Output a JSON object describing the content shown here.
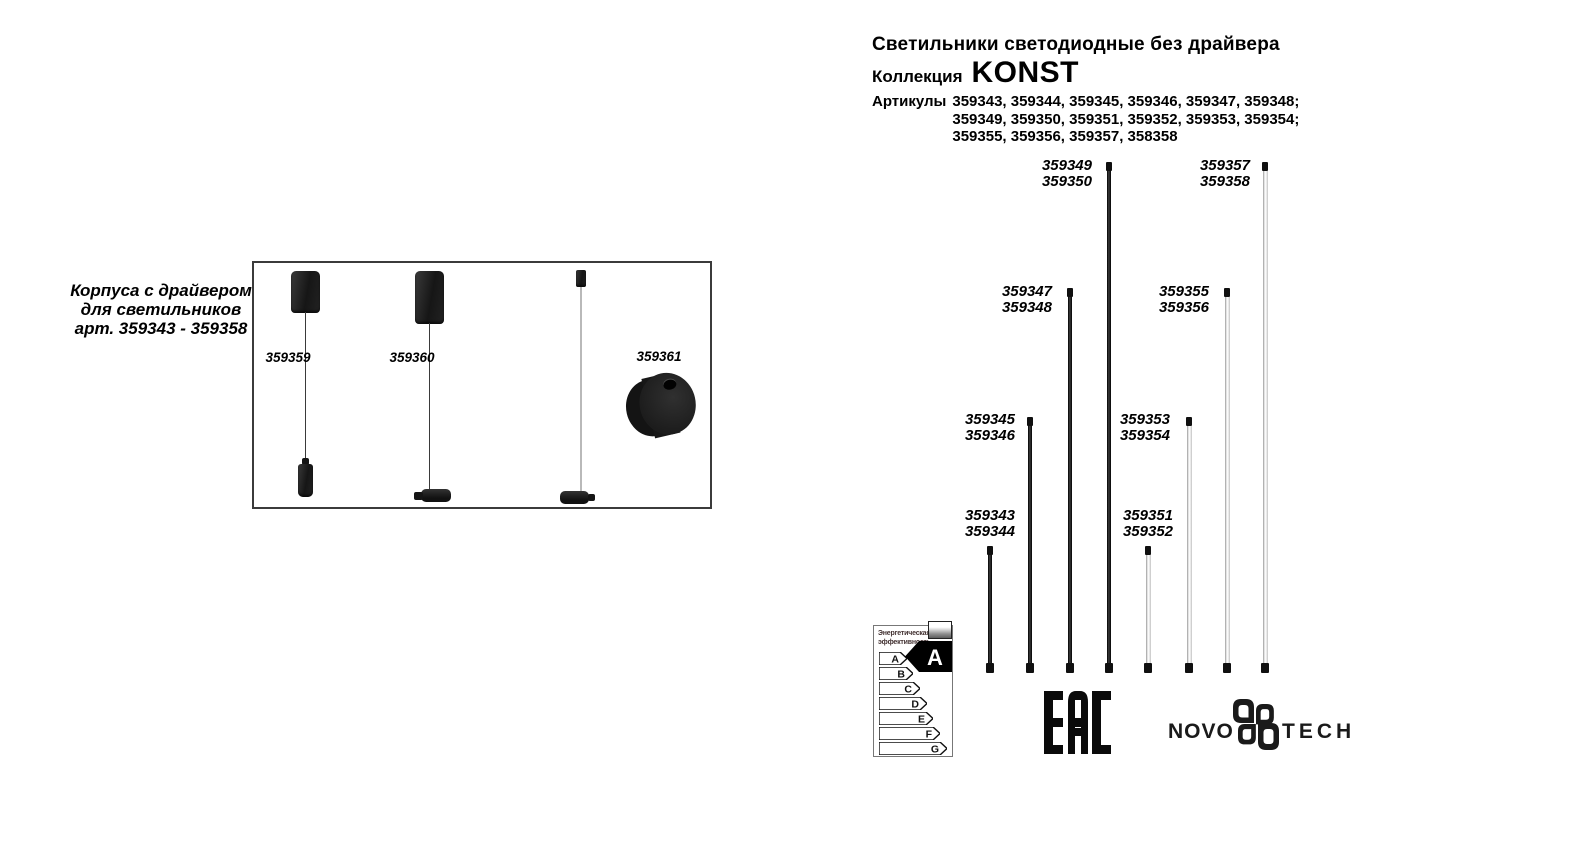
{
  "header": {
    "title": "Светильники светодиодные без драйвера",
    "collection_label": "Коллекция",
    "collection_name": "KONST",
    "articles_label": "Артикулы",
    "articles_lines": [
      "359343, 359344, 359345, 359346, 359347, 359348;",
      "359349, 359350, 359351, 359352, 359353, 359354;",
      "359355, 359356, 359357, 358358"
    ]
  },
  "driver_box": {
    "caption_lines": [
      "Корпуса с драйвером",
      "для светильников",
      "арт. 359343 - 359358"
    ],
    "products": [
      {
        "article": "359359"
      },
      {
        "article": "359360"
      },
      {
        "article": "359361"
      }
    ]
  },
  "rods": [
    {
      "line1": "359343",
      "line2": "359344",
      "finish": "black"
    },
    {
      "line1": "359345",
      "line2": "359346",
      "finish": "black"
    },
    {
      "line1": "359347",
      "line2": "359348",
      "finish": "black"
    },
    {
      "line1": "359349",
      "line2": "359350",
      "finish": "black"
    },
    {
      "line1": "359351",
      "line2": "359352",
      "finish": "white"
    },
    {
      "line1": "359353",
      "line2": "359354",
      "finish": "white"
    },
    {
      "line1": "359355",
      "line2": "359356",
      "finish": "white"
    },
    {
      "line1": "359357",
      "line2": "359358",
      "finish": "white"
    }
  ],
  "energy_label": {
    "title_lines": [
      "Энергетическая",
      "эффективность"
    ],
    "classes": [
      "A",
      "B",
      "C",
      "D",
      "E",
      "F",
      "G"
    ],
    "rating": "A"
  },
  "logos": {
    "eac": "EAC",
    "brand_left": "NOVO",
    "brand_right": "TECH"
  },
  "colors": {
    "ink": "#000000",
    "rod_white": "#e8e8e8",
    "box_border": "#3b3b3b"
  }
}
